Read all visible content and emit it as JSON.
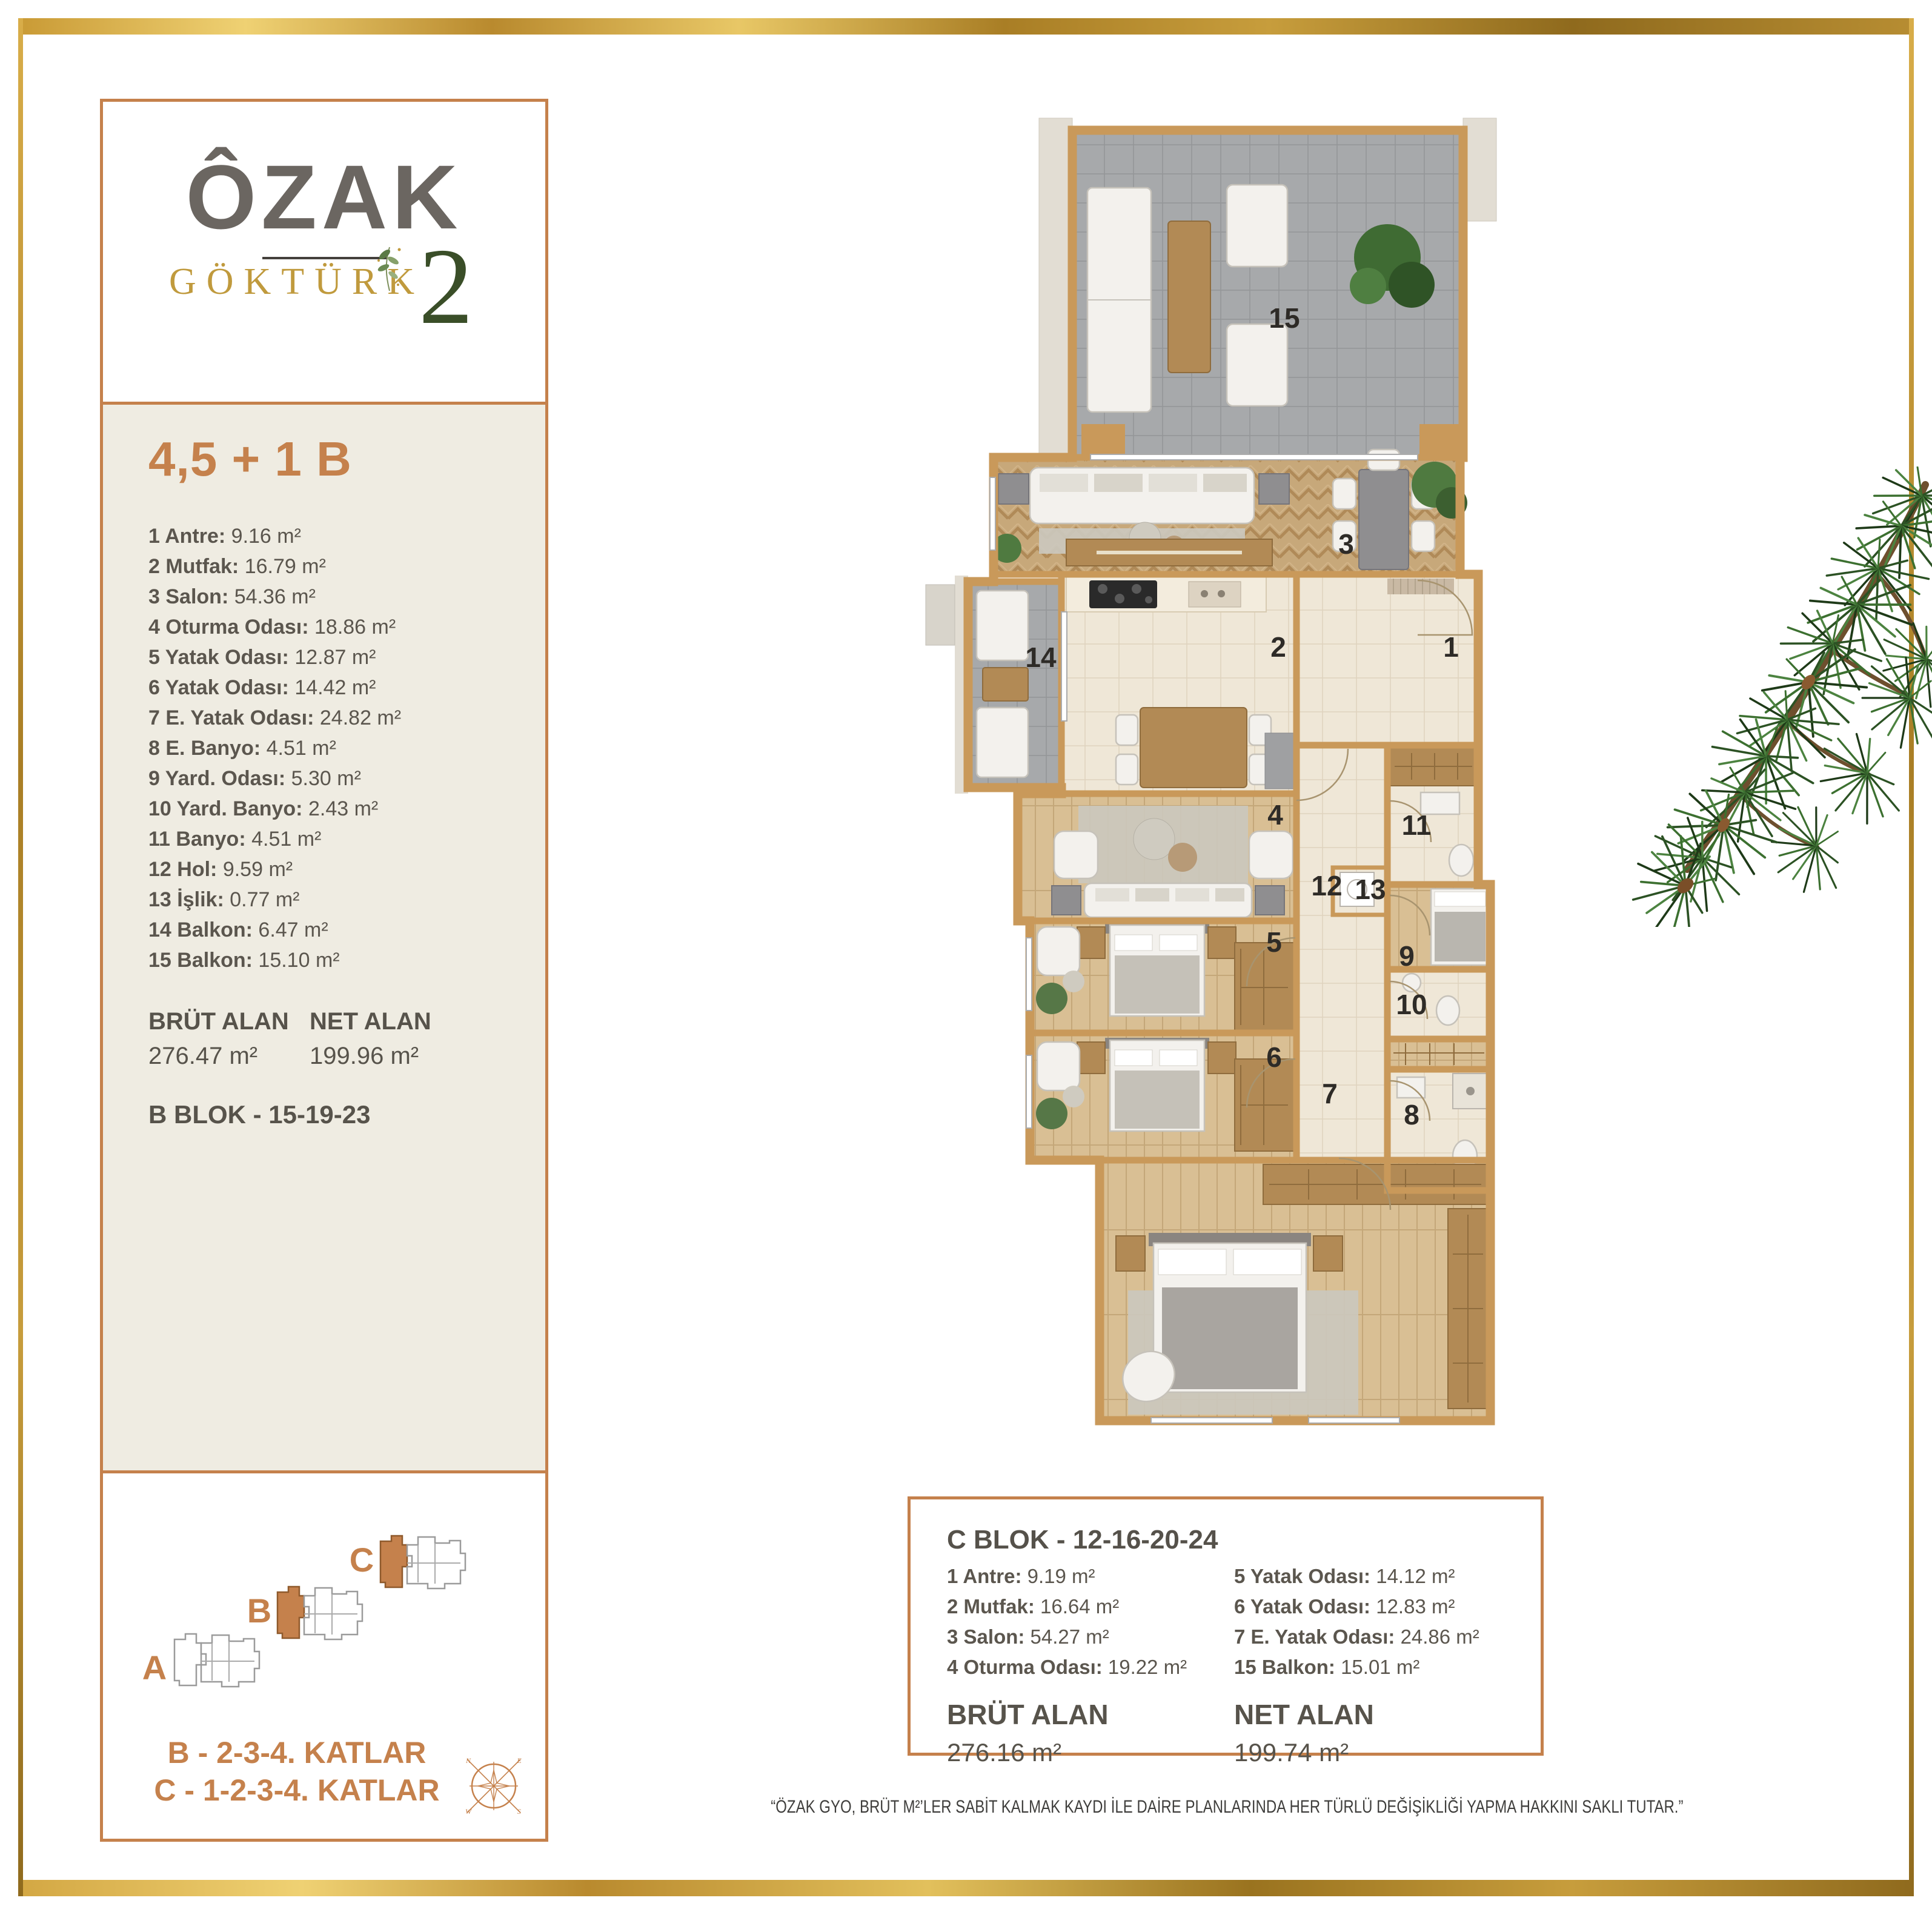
{
  "logo": {
    "brand": "ÔZAK",
    "project": "GÖKTÜRK",
    "number": "2"
  },
  "unit": {
    "title": "4,5 + 1 B",
    "rooms": [
      {
        "num": "1",
        "label": "Antre:",
        "value": "9.16 m²"
      },
      {
        "num": "2",
        "label": "Mutfak:",
        "value": "16.79 m²"
      },
      {
        "num": "3",
        "label": "Salon:",
        "value": "54.36 m²"
      },
      {
        "num": "4",
        "label": "Oturma Odası:",
        "value": "18.86 m²"
      },
      {
        "num": "5",
        "label": "Yatak Odası:",
        "value": "12.87 m²"
      },
      {
        "num": "6",
        "label": "Yatak Odası:",
        "value": "14.42 m²"
      },
      {
        "num": "7",
        "label": "E. Yatak Odası:",
        "value": "24.82 m²"
      },
      {
        "num": "8",
        "label": "E. Banyo:",
        "value": "4.51 m²"
      },
      {
        "num": "9",
        "label": "Yard. Odası:",
        "value": "5.30 m²"
      },
      {
        "num": "10",
        "label": "Yard. Banyo:",
        "value": "2.43 m²"
      },
      {
        "num": "11",
        "label": "Banyo:",
        "value": "4.51 m²"
      },
      {
        "num": "12",
        "label": "Hol:",
        "value": "9.59 m²"
      },
      {
        "num": "13",
        "label": "İşlik:",
        "value": "0.77 m²"
      },
      {
        "num": "14",
        "label": "Balkon:",
        "value": "6.47 m²"
      },
      {
        "num": "15",
        "label": "Balkon:",
        "value": "15.10 m²"
      }
    ],
    "brut_label": "BRÜT ALAN",
    "brut_value": "276.47 m²",
    "net_label": "NET ALAN",
    "net_value": "199.96 m²",
    "block_line": "B BLOK - 15-19-23"
  },
  "siteplan": {
    "letters": {
      "a": "A",
      "b": "B",
      "c": "C"
    },
    "floors_b": "B - 2-3-4. KATLAR",
    "floors_c": "C - 1-2-3-4. KATLAR",
    "compass": {
      "n": "N",
      "e": "E",
      "w": "W",
      "s": "S"
    }
  },
  "c_blok": {
    "title": "C BLOK - 12-16-20-24",
    "left": [
      {
        "num": "1",
        "label": "Antre:",
        "value": "9.19 m²"
      },
      {
        "num": "2",
        "label": "Mutfak:",
        "value": "16.64 m²"
      },
      {
        "num": "3",
        "label": "Salon:",
        "value": "54.27 m²"
      },
      {
        "num": "4",
        "label": "Oturma Odası:",
        "value": "19.22 m²"
      }
    ],
    "right": [
      {
        "num": "5",
        "label": "Yatak Odası:",
        "value": "14.12 m²"
      },
      {
        "num": "6",
        "label": "Yatak Odası:",
        "value": "12.83 m²"
      },
      {
        "num": "7",
        "label": "E. Yatak Odası:",
        "value": "24.86 m²"
      },
      {
        "num": "15",
        "label": "Balkon:",
        "value": "15.01 m²"
      }
    ],
    "brut_label": "BRÜT ALAN",
    "brut_value": "276.16 m²",
    "net_label": "NET ALAN",
    "net_value": "199.74 m²"
  },
  "disclaimer": "“ÖZAK GYO, BRÜT M²’LER SABİT KALMAK KAYDI İLE DAİRE PLANLARINDA HER TÜRLÜ DEĞİŞİKLİĞİ YAPMA HAKKINI SAKLI TUTAR.”"
}
